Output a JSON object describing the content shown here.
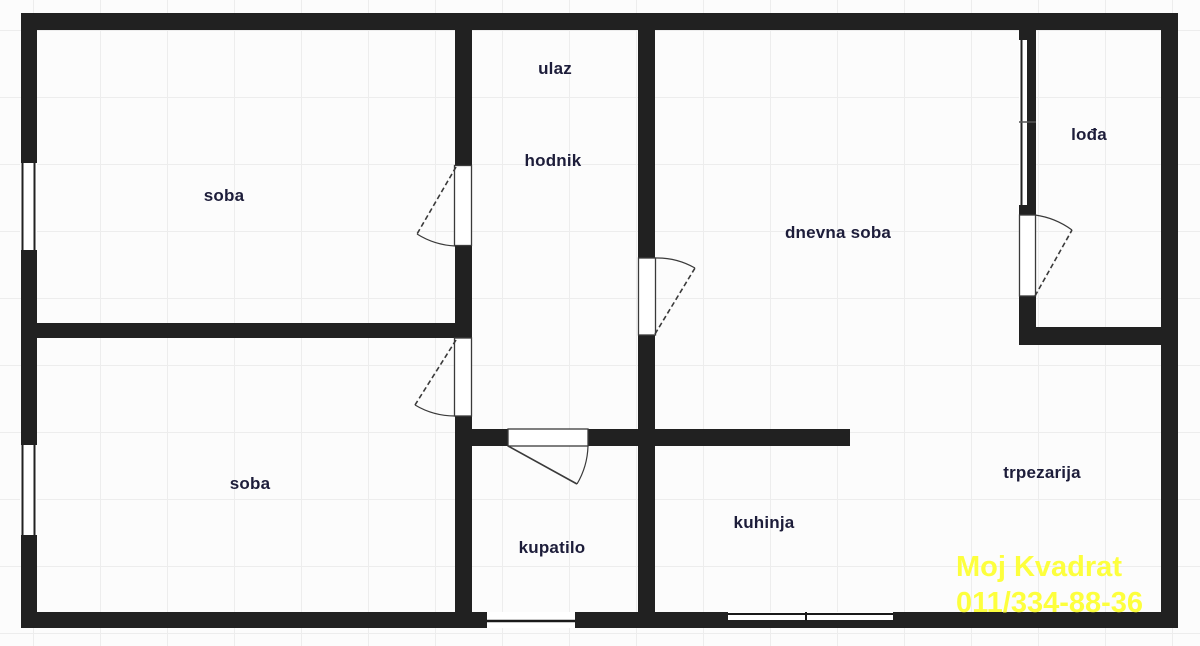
{
  "plan": {
    "title": "apartment floor plan",
    "rooms": {
      "soba_top": {
        "label": "soba"
      },
      "ulaz": {
        "label": "ulaz"
      },
      "hodnik": {
        "label": "hodnik"
      },
      "dnevna_soba": {
        "label": "dnevna soba"
      },
      "lodja": {
        "label": "lođa"
      },
      "soba_bottom": {
        "label": "soba"
      },
      "kupatilo": {
        "label": "kupatilo"
      },
      "kuhinja": {
        "label": "kuhinja"
      },
      "trpezarija": {
        "label": "trpezarija"
      }
    },
    "features": [
      "window-left-top",
      "window-left-bottom",
      "window-lodja",
      "window-bottom-kupatilo",
      "window-bottom-kuhinja",
      "door-soba-top",
      "door-soba-bottom",
      "door-dnevna-soba",
      "door-kupatilo",
      "door-lodja"
    ]
  },
  "watermark": {
    "line1": "Moj Kvadrat",
    "line2": "011/334-88-36"
  },
  "colors": {
    "wall": "#212121",
    "room-label": "#1d1d3a",
    "watermark": "#fdff3d",
    "background": "#fcfcfc",
    "grid-line": "#ededed",
    "door-line": "#3a3a3a"
  }
}
